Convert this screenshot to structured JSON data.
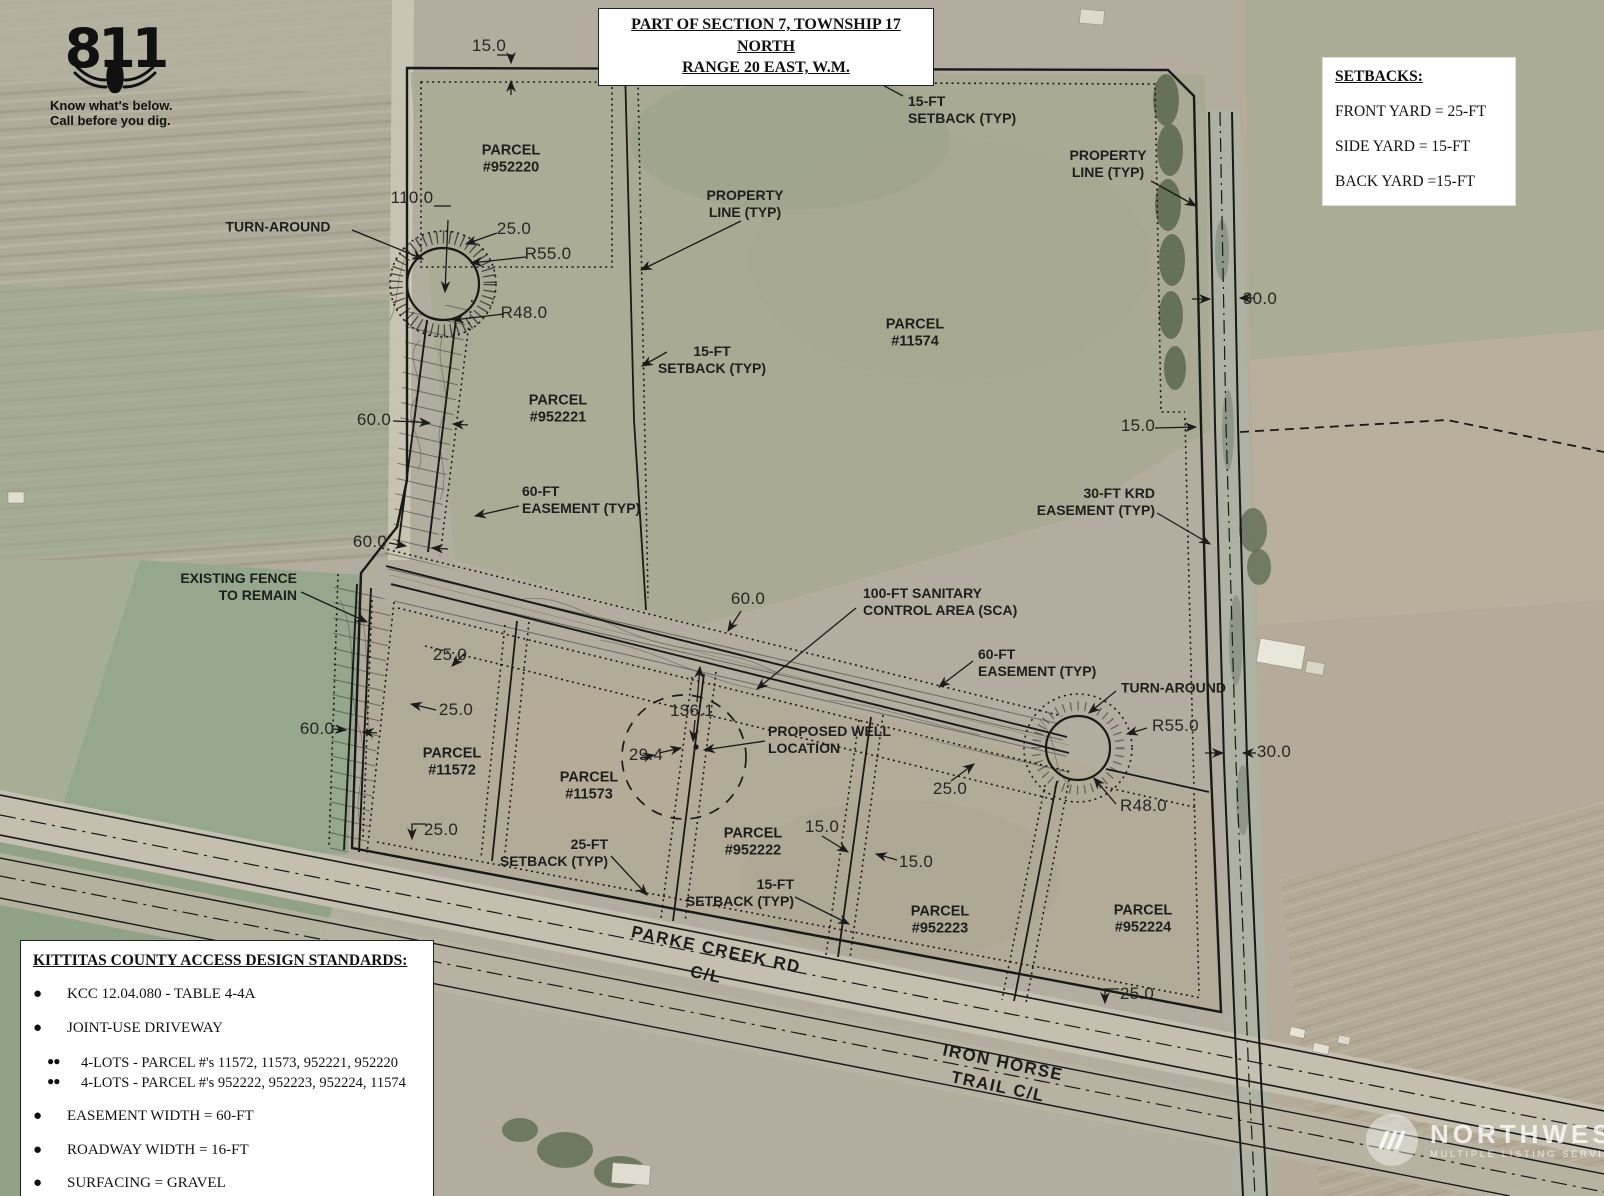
{
  "title_block": {
    "line1": "PART OF SECTION 7, TOWNSHIP 17 NORTH",
    "line2": "RANGE 20 EAST, W.M."
  },
  "call811": {
    "number": "811",
    "tag1": "Know what's below.",
    "tag2": "Call before you dig."
  },
  "setbacks": {
    "title": "SETBACKS:",
    "items": [
      "FRONT YARD = 25-FT",
      "SIDE YARD = 15-FT",
      "BACK YARD =15-FT"
    ]
  },
  "standards": {
    "title": "KITTITAS COUNTY ACCESS DESIGN STANDARDS:",
    "items": [
      {
        "level": 1,
        "text": "KCC 12.04.080 - TABLE 4-4A"
      },
      {
        "level": 1,
        "text": "JOINT-USE DRIVEWAY"
      },
      {
        "level": 2,
        "text": "4-LOTS - PARCEL #'s 11572, 11573, 952221, 952220"
      },
      {
        "level": 2,
        "text": "4-LOTS - PARCEL #'s 952222, 952223, 952224, 11574"
      },
      {
        "level": 1,
        "text": "EASEMENT WIDTH = 60-FT"
      },
      {
        "level": 1,
        "text": "ROADWAY WIDTH = 16-FT"
      },
      {
        "level": 1,
        "text": "SURFACING = GRAVEL"
      }
    ]
  },
  "watermark": {
    "name": "NORTHWEST",
    "sub": "MULTIPLE LISTING SERVICE"
  },
  "map_labels": [
    {
      "id": "dim-15-top",
      "text": "15.0",
      "x": 489,
      "y": 46,
      "cls": "dim",
      "align": "c"
    },
    {
      "id": "parcel-952220",
      "text": "PARCEL\n#952220",
      "x": 511,
      "y": 160,
      "cls": "parcel",
      "align": "c"
    },
    {
      "id": "dim-110",
      "text": "110.0",
      "x": 412,
      "y": 198,
      "cls": "dim",
      "align": "c"
    },
    {
      "id": "label-turn-around-left",
      "text": "TURN-AROUND",
      "x": 278,
      "y": 227,
      "cls": "lbl",
      "align": "c"
    },
    {
      "id": "dim-25-a",
      "text": "25.0",
      "x": 514,
      "y": 229,
      "cls": "dim",
      "align": "c"
    },
    {
      "id": "dim-r55-left",
      "text": "R55.0",
      "x": 548,
      "y": 254,
      "cls": "dim",
      "align": "c"
    },
    {
      "id": "dim-r48-left",
      "text": "R48.0",
      "x": 524,
      "y": 313,
      "cls": "dim",
      "align": "c"
    },
    {
      "id": "label-15ft-setback-top",
      "text": "15-FT\nSETBACK (TYP)",
      "x": 908,
      "y": 110,
      "cls": "lbl",
      "align": "l"
    },
    {
      "id": "label-property-line-left",
      "text": "PROPERTY\nLINE (TYP)",
      "x": 745,
      "y": 204,
      "cls": "lbl",
      "align": "c"
    },
    {
      "id": "label-property-line-right",
      "text": "PROPERTY\nLINE (TYP)",
      "x": 1108,
      "y": 164,
      "cls": "lbl",
      "align": "c"
    },
    {
      "id": "parcel-11574",
      "text": "PARCEL\n#11574",
      "x": 915,
      "y": 334,
      "cls": "parcel",
      "align": "c"
    },
    {
      "id": "label-15ft-setback-mid",
      "text": "15-FT\nSETBACK (TYP)",
      "x": 712,
      "y": 360,
      "cls": "lbl",
      "align": "c"
    },
    {
      "id": "parcel-952221",
      "text": "PARCEL\n#952221",
      "x": 558,
      "y": 410,
      "cls": "parcel",
      "align": "c"
    },
    {
      "id": "dim-60-a",
      "text": "60.0",
      "x": 374,
      "y": 420,
      "cls": "dim",
      "align": "c"
    },
    {
      "id": "label-60ft-easement-left",
      "text": "60-FT\nEASEMENT (TYP)",
      "x": 522,
      "y": 500,
      "cls": "lbl",
      "align": "l"
    },
    {
      "id": "dim-60-b",
      "text": "60.0",
      "x": 370,
      "y": 542,
      "cls": "dim",
      "align": "c"
    },
    {
      "id": "label-existing-fence",
      "text": "EXISTING FENCE\nTO REMAIN",
      "x": 297,
      "y": 587,
      "cls": "lbl",
      "align": "r"
    },
    {
      "id": "label-30ft-krd-easement",
      "text": "30-FT KRD\nEASEMENT (TYP)",
      "x": 1155,
      "y": 502,
      "cls": "lbl",
      "align": "r"
    },
    {
      "id": "dim-15-right",
      "text": "15.0",
      "x": 1138,
      "y": 426,
      "cls": "dim",
      "align": "c"
    },
    {
      "id": "dim-30-top",
      "text": "30.0",
      "x": 1260,
      "y": 299,
      "cls": "dim",
      "align": "c"
    },
    {
      "id": "dim-60-c",
      "text": "60.0",
      "x": 748,
      "y": 599,
      "cls": "dim",
      "align": "c"
    },
    {
      "id": "label-100ft-sca",
      "text": "100-FT SANITARY\nCONTROL AREA (SCA)",
      "x": 863,
      "y": 602,
      "cls": "lbl",
      "align": "l"
    },
    {
      "id": "label-60ft-easement-right",
      "text": "60-FT\nEASEMENT (TYP)",
      "x": 978,
      "y": 663,
      "cls": "lbl",
      "align": "l"
    },
    {
      "id": "label-turn-around-right",
      "text": "TURN-AROUND",
      "x": 1121,
      "y": 688,
      "cls": "lbl",
      "align": "l"
    },
    {
      "id": "dim-r55-right",
      "text": "R55.0",
      "x": 1152,
      "y": 726,
      "cls": "dim",
      "align": "l"
    },
    {
      "id": "dim-30-bottom",
      "text": "30.0",
      "x": 1274,
      "y": 752,
      "cls": "dim",
      "align": "c"
    },
    {
      "id": "dim-r48-right",
      "text": "R48.0",
      "x": 1120,
      "y": 806,
      "cls": "dim",
      "align": "l"
    },
    {
      "id": "dim-25-b",
      "text": "25.0",
      "x": 450,
      "y": 655,
      "cls": "dim",
      "align": "c"
    },
    {
      "id": "dim-25-c",
      "text": "25.0",
      "x": 456,
      "y": 710,
      "cls": "dim",
      "align": "c"
    },
    {
      "id": "dim-60-d",
      "text": "60.0",
      "x": 317,
      "y": 729,
      "cls": "dim",
      "align": "c"
    },
    {
      "id": "parcel-11572",
      "text": "PARCEL\n#11572",
      "x": 452,
      "y": 763,
      "cls": "parcel",
      "align": "c"
    },
    {
      "id": "dim-25-d",
      "text": "25.0",
      "x": 441,
      "y": 830,
      "cls": "dim",
      "align": "c"
    },
    {
      "id": "dim-136-1",
      "text": "136.1",
      "x": 692,
      "y": 711,
      "cls": "dim",
      "align": "c"
    },
    {
      "id": "dim-29-4",
      "text": "29.4",
      "x": 646,
      "y": 755,
      "cls": "dim",
      "align": "c"
    },
    {
      "id": "label-proposed-well",
      "text": "PROPOSED WELL\nLOCATION",
      "x": 768,
      "y": 740,
      "cls": "lbl",
      "align": "l"
    },
    {
      "id": "parcel-11573",
      "text": "PARCEL\n#11573",
      "x": 589,
      "y": 787,
      "cls": "parcel",
      "align": "c"
    },
    {
      "id": "label-25ft-setback",
      "text": "25-FT\nSETBACK (TYP)",
      "x": 608,
      "y": 853,
      "cls": "lbl",
      "align": "r"
    },
    {
      "id": "parcel-952222",
      "text": "PARCEL\n#952222",
      "x": 753,
      "y": 843,
      "cls": "parcel",
      "align": "c"
    },
    {
      "id": "dim-15-b",
      "text": "15.0",
      "x": 822,
      "y": 827,
      "cls": "dim",
      "align": "c"
    },
    {
      "id": "dim-15-c",
      "text": "15.0",
      "x": 916,
      "y": 862,
      "cls": "dim",
      "align": "c"
    },
    {
      "id": "label-15ft-setback-bottom",
      "text": "15-FT\nSETBACK (TYP)",
      "x": 794,
      "y": 893,
      "cls": "lbl",
      "align": "r"
    },
    {
      "id": "dim-25-e",
      "text": "25.0",
      "x": 950,
      "y": 789,
      "cls": "dim",
      "align": "c"
    },
    {
      "id": "parcel-952223",
      "text": "PARCEL\n#952223",
      "x": 940,
      "y": 921,
      "cls": "parcel",
      "align": "c"
    },
    {
      "id": "parcel-952224",
      "text": "PARCEL\n#952224",
      "x": 1143,
      "y": 920,
      "cls": "parcel",
      "align": "c"
    },
    {
      "id": "dim-25-f",
      "text": "25.0",
      "x": 1137,
      "y": 994,
      "cls": "dim",
      "align": "c"
    },
    {
      "id": "road-parke-creek-rd",
      "text": "PARKE CREEK RD",
      "x": 716,
      "y": 950,
      "cls": "road",
      "align": "c",
      "rot": 12
    },
    {
      "id": "road-parke-creek-cl",
      "text": "C/L",
      "x": 706,
      "y": 975,
      "cls": "road",
      "align": "c",
      "rot": 12
    },
    {
      "id": "road-iron-horse",
      "text": "IRON HORSE",
      "x": 1003,
      "y": 1063,
      "cls": "road",
      "align": "c",
      "rot": 12
    },
    {
      "id": "road-iron-horse-cl",
      "text": "TRAIL C/L",
      "x": 998,
      "y": 1087,
      "cls": "road",
      "align": "c",
      "rot": 12
    }
  ]
}
